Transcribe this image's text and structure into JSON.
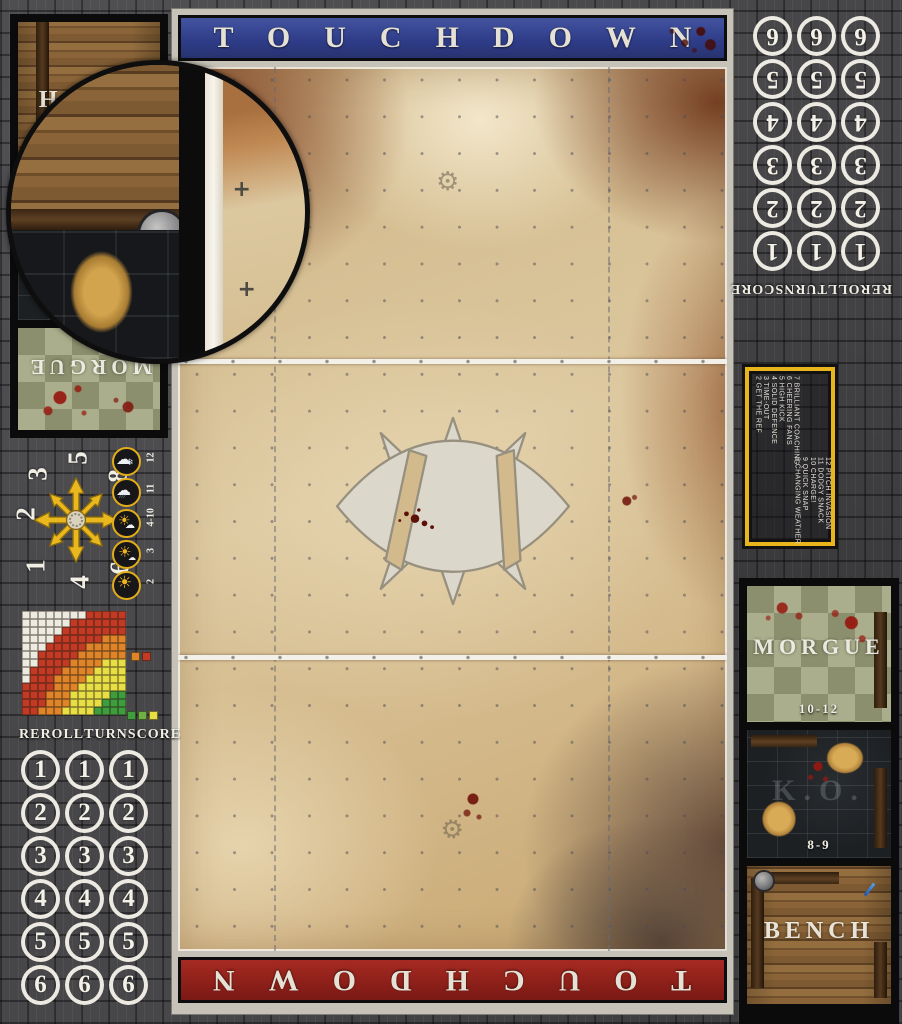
{
  "banners": {
    "top_label": "TOUCHDOWN",
    "bottom_label": "TOUCHDOWN"
  },
  "tracker": {
    "labels": [
      "REROLL",
      "TURN",
      "SCORE"
    ],
    "left_values": [
      "1",
      "2",
      "3",
      "4",
      "5",
      "6"
    ],
    "right_values": [
      "6",
      "5",
      "4",
      "3",
      "2",
      "1"
    ]
  },
  "dugout_left": {
    "bench_label": "BENCH",
    "morgue_label": "MORGUE"
  },
  "dugout_right": {
    "morgue_label": "MORGUE",
    "morgue_range": "10-12",
    "ko_label": "K.O.",
    "ko_range": "8-9",
    "bench_label": "BENCH"
  },
  "kickoff_table": {
    "column_a": [
      "2 GET THE REF",
      "3 TIME-OUT",
      "4 SOLID DEFENCE",
      "5 HIGH KICK",
      "6 CHEERING FANS",
      "7 BRILLIANT COACHING"
    ],
    "column_b": [
      "8 CHANGING WEATHER",
      "9 QUICK SNAP",
      "10 CHARGE!",
      "11 DODGY SNACK",
      "12 PITCH INVASION"
    ]
  },
  "weather_table": [
    {
      "icon": "blizzard-icon",
      "roll": "12"
    },
    {
      "icon": "rain-icon",
      "roll": "11"
    },
    {
      "icon": "fair-icon",
      "roll": "4-10"
    },
    {
      "icon": "sunny-icon",
      "roll": "3"
    },
    {
      "icon": "scorching-icon",
      "roll": "2"
    }
  ],
  "scatter_template": {
    "numbers": {
      "nw": "3",
      "n": "5",
      "ne": "8",
      "w": "2",
      "e": "7",
      "sw": "1",
      "s": "4",
      "se": "6"
    }
  },
  "range_ruler": {
    "rows": [
      "WWWWWWWWRRRRR",
      "WWWWWWRRRRRRR",
      "WWWWWRRRRRRRR",
      "WWWWRRRRRROOO",
      "WWWRRRRROOOOO",
      "WWRRRRROOOOOO",
      "WWRRRROOOOYYY",
      "WRRRROOOOYYYY",
      "WRRROOOOYYYYY",
      "RRRROOOYYYYYY",
      "RRROOOYYYYYGG",
      "RRROOOYYYYGGG",
      "RROOOYYYYGGGG"
    ],
    "palette": {
      "W": "#edebe0",
      "R": "#c23a24",
      "O": "#e08428",
      "Y": "#e8df45",
      "G": "#3e9e3e",
      "H": "#6faf44"
    },
    "legend_top": [
      "O",
      "R"
    ],
    "legend_bottom": [
      "G",
      "H",
      "Y"
    ]
  },
  "accent_colors": {
    "banner_blue": "#34428f",
    "banner_red": "#96241d",
    "template_yellow": "#e8b61c"
  }
}
